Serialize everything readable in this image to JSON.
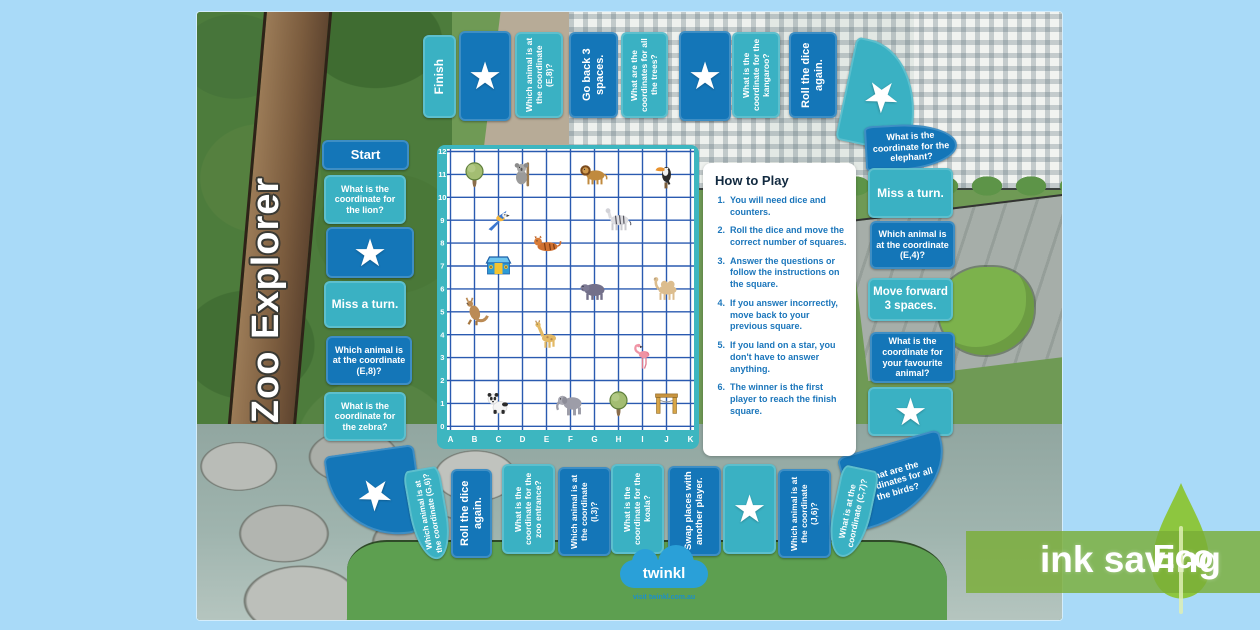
{
  "title": "Zoo Explorer",
  "path": {
    "top_row": [
      {
        "id": "finish",
        "label": "Finish",
        "style": "teal"
      },
      {
        "id": "star-1",
        "star": true,
        "style": "dark"
      },
      {
        "id": "q-animal-e8",
        "label": "Which animal is at the coordinate (E,8)?",
        "style": "teal"
      },
      {
        "id": "go-back-3",
        "label": "Go back 3 spaces.",
        "style": "dark"
      },
      {
        "id": "q-coords-trees",
        "label": "What are the coordinates for all the trees?",
        "style": "teal"
      },
      {
        "id": "star-2",
        "star": true,
        "style": "dark"
      },
      {
        "id": "q-coord-kangaroo",
        "label": "What is the coordinate for the kangaroo?",
        "style": "teal"
      },
      {
        "id": "roll-dice-1",
        "label": "Roll the dice again.",
        "style": "dark"
      },
      {
        "id": "star-corner-top-right",
        "star": true,
        "style": "teal"
      }
    ],
    "left_column": [
      {
        "id": "start",
        "label": "Start",
        "style": "dark"
      },
      {
        "id": "q-coord-lion",
        "label": "What is the coordinate for the lion?",
        "style": "teal"
      },
      {
        "id": "star-3",
        "star": true,
        "style": "dark"
      },
      {
        "id": "miss-turn-1",
        "label": "Miss a turn.",
        "style": "teal"
      },
      {
        "id": "q-animal-e8-2",
        "label": "Which animal is at the coordinate (E,8)?",
        "style": "dark"
      },
      {
        "id": "q-coord-zebra",
        "label": "What is the coordinate for the zebra?",
        "style": "teal"
      }
    ],
    "right_column": [
      {
        "id": "q-coord-elephant",
        "label": "What is the coordinate for the elephant?",
        "style": "dark"
      },
      {
        "id": "miss-turn-2",
        "label": "Miss a turn.",
        "style": "teal"
      },
      {
        "id": "q-animal-e4",
        "label": "Which animal is at the coordinate (E,4)?",
        "style": "dark"
      },
      {
        "id": "move-forward-3",
        "label": "Move forward 3 spaces.",
        "style": "teal"
      },
      {
        "id": "q-coord-favourite",
        "label": "What is the coordinate for your favourite animal?",
        "style": "dark"
      },
      {
        "id": "star-4",
        "star": true,
        "style": "teal"
      },
      {
        "id": "q-coords-birds",
        "label": "What are the coordinates for all the birds?",
        "style": "dark"
      }
    ],
    "bottom_row": [
      {
        "id": "star-corner-bottom-left",
        "star": true,
        "style": "dark"
      },
      {
        "id": "q-animal-g6",
        "label": "Which animal is at the coordinate (G,6)?",
        "style": "teal"
      },
      {
        "id": "roll-dice-2",
        "label": "Roll the dice again.",
        "style": "dark"
      },
      {
        "id": "q-coord-zoo-entrance",
        "label": "What is the coordinate for the zoo entrance?",
        "style": "teal"
      },
      {
        "id": "q-animal-i3",
        "label": "Which animal is at the coordinate (I,3)?",
        "style": "dark"
      },
      {
        "id": "q-coord-koala",
        "label": "What is the coordinate for the koala?",
        "style": "teal"
      },
      {
        "id": "swap-places",
        "label": "Swap places with another player.",
        "style": "dark"
      },
      {
        "id": "star-5",
        "star": true,
        "style": "teal"
      },
      {
        "id": "q-animal-j6",
        "label": "Which animal is at the coordinate (J,6)?",
        "style": "dark"
      },
      {
        "id": "q-what-c7",
        "label": "What is at the coordinate (C,7)?",
        "style": "teal"
      }
    ]
  },
  "grid": {
    "x_labels": [
      "A",
      "B",
      "C",
      "D",
      "E",
      "F",
      "G",
      "H",
      "I",
      "J",
      "K"
    ],
    "y_labels": [
      "0",
      "1",
      "2",
      "3",
      "4",
      "5",
      "6",
      "7",
      "8",
      "9",
      "10",
      "11",
      "12"
    ],
    "animals": [
      {
        "name": "tree",
        "col": "B",
        "row": 11
      },
      {
        "name": "koala",
        "col": "D",
        "row": 11
      },
      {
        "name": "lion",
        "col": "G",
        "row": 11
      },
      {
        "name": "toucan",
        "col": "J",
        "row": 11
      },
      {
        "name": "parrot",
        "col": "C",
        "row": 9
      },
      {
        "name": "zebra",
        "col": "H",
        "row": 9
      },
      {
        "name": "tiger",
        "col": "E",
        "row": 8
      },
      {
        "name": "zoo-entrance",
        "col": "C",
        "row": 7
      },
      {
        "name": "hippo",
        "col": "G",
        "row": 6
      },
      {
        "name": "camel",
        "col": "J",
        "row": 6
      },
      {
        "name": "kangaroo",
        "col": "B",
        "row": 5
      },
      {
        "name": "giraffe",
        "col": "E",
        "row": 4
      },
      {
        "name": "flamingo",
        "col": "I",
        "row": 3
      },
      {
        "name": "panda",
        "col": "C",
        "row": 1
      },
      {
        "name": "elephant",
        "col": "F",
        "row": 1
      },
      {
        "name": "tree",
        "col": "H",
        "row": 1
      },
      {
        "name": "gate",
        "col": "J",
        "row": 1
      }
    ]
  },
  "how_to_play": {
    "title": "How to Play",
    "steps": [
      "You will need dice and counters.",
      "Roll the dice and move the correct number of squares.",
      "Answer the questions or follow the instructions on the square.",
      "If you answer incorrectly, move back to your previous square.",
      "If you land on a star, you don't have to answer anything.",
      "The winner is the first player to reach the finish square."
    ]
  },
  "logo": {
    "brand": "twinkl",
    "tagline": "visit twinkl.com.au"
  },
  "eco": {
    "label": "ink saving",
    "badge": "Eco"
  },
  "colors": {
    "page_bg": "#a9daf8",
    "dark_square": "#1476b8",
    "teal_square": "#3ab1c3",
    "grid_frame": "#3db6c0",
    "grid_line": "#2a5ab0",
    "step_text": "#1b76bb",
    "eco_green": "#8dc63f",
    "logo_blue": "#2aa0d8"
  }
}
